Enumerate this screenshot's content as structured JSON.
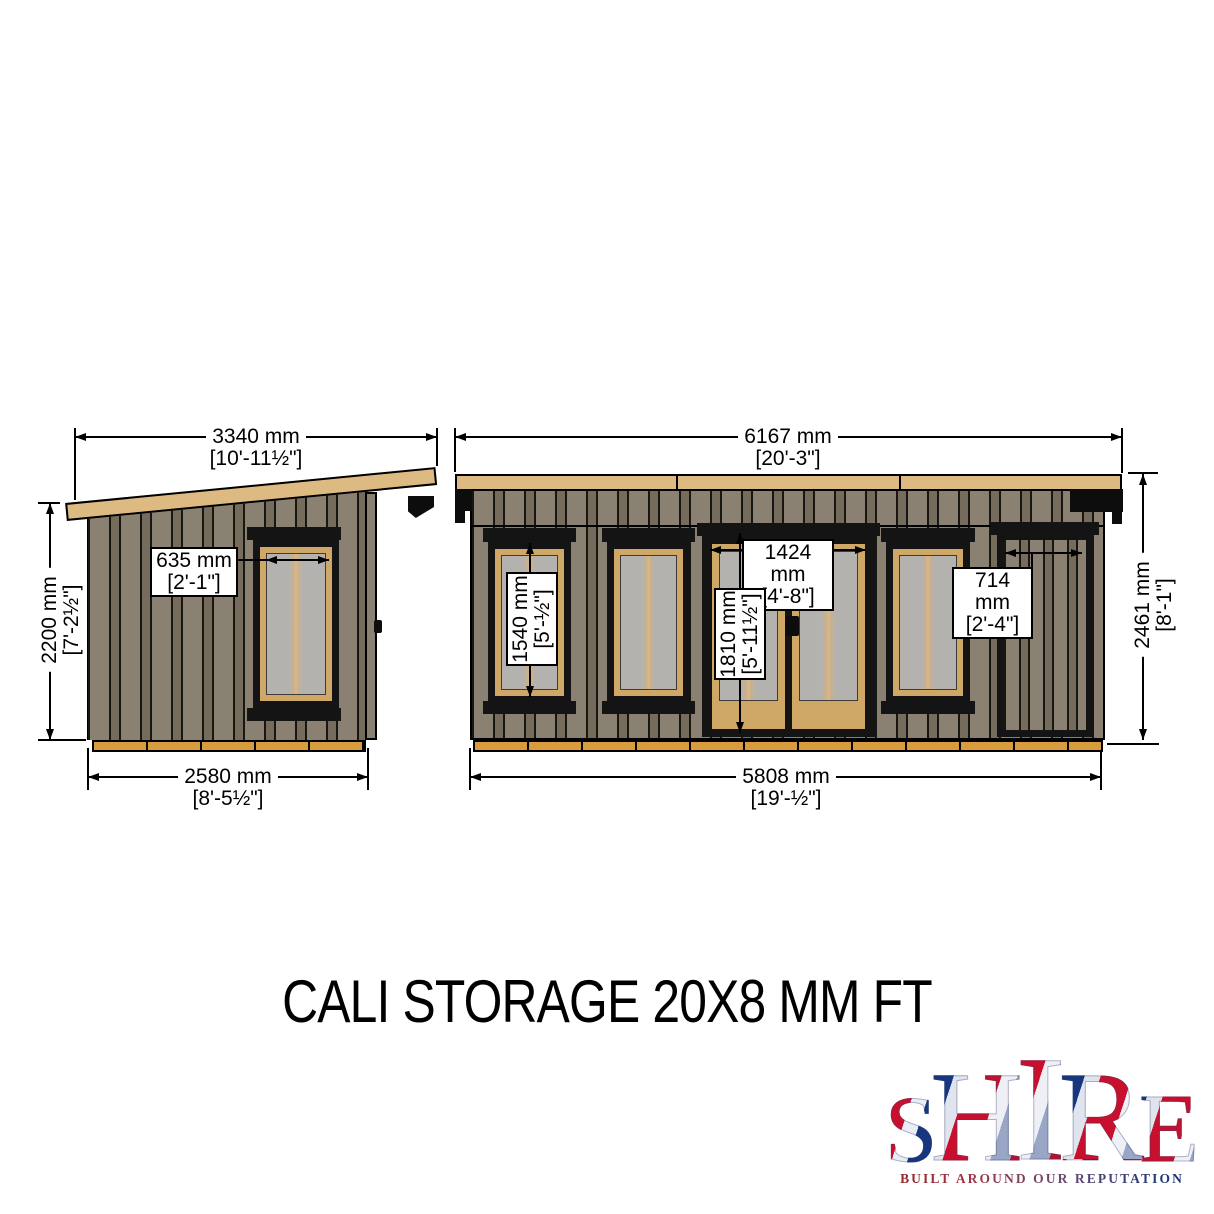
{
  "title": "CALI STORAGE 20X8 MM FT",
  "side_view": {
    "roof_width": {
      "mm": "3340 mm",
      "ftin": "[10'-11½\"]"
    },
    "wall_height": {
      "mm": "2200 mm",
      "ftin": "[7'-2½\"]"
    },
    "base_width": {
      "mm": "2580 mm",
      "ftin": "[8'-5½\"]"
    },
    "window_width": {
      "mm": "635 mm",
      "ftin": "[2'-1\"]"
    }
  },
  "front_view": {
    "roof_width": {
      "mm": "6167 mm",
      "ftin": "[20'-3\"]"
    },
    "wall_height": {
      "mm": "2461 mm",
      "ftin": "[8'-1\"]"
    },
    "base_width": {
      "mm": "5808 mm",
      "ftin": "[19'-½\"]"
    },
    "window_height": {
      "mm": "1540 mm",
      "ftin": "[5'-½\"]"
    },
    "door_width": {
      "mm": "1424 mm",
      "ftin": "[4'-8\"]"
    },
    "door_height": {
      "mm": "1810 mm",
      "ftin": "[5'-11½\"]"
    },
    "storage_door_width": {
      "mm": "714 mm",
      "ftin": "[2'-4\"]"
    }
  },
  "logo": {
    "letters": [
      "S",
      "H",
      "I",
      "R",
      "E"
    ],
    "tagline": "BUILT AROUND OUR REPUTATION"
  },
  "colors": {
    "cladding": "#8b8173",
    "batten": "#756c5e",
    "fascia": "#dcba81",
    "base_skid": "#d89c3c",
    "frame_wood": "#cfa868",
    "glass": "#b4b2af",
    "outline": "#111111",
    "flag_red": "#c8102e",
    "flag_blue": "#16367f"
  }
}
